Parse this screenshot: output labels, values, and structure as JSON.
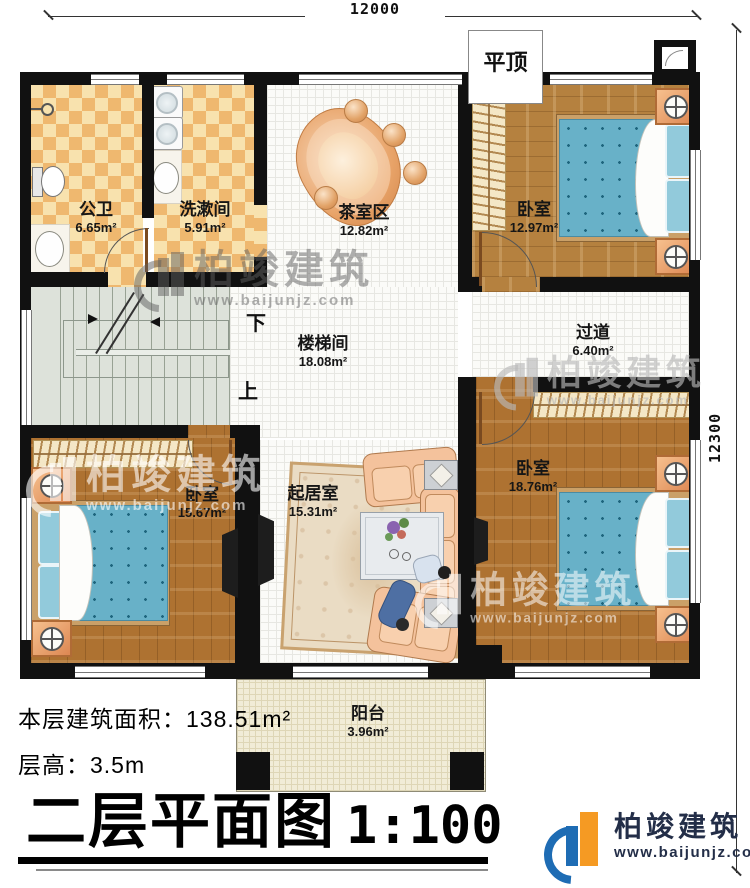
{
  "dimensions": {
    "width": "12000",
    "height": "12300"
  },
  "annotations": {
    "roof": "平顶",
    "stairs_down": "下",
    "stairs_up": "上"
  },
  "rooms": [
    {
      "name": "公卫",
      "area": "6.65m²"
    },
    {
      "name": "洗漱间",
      "area": "5.91m²"
    },
    {
      "name": "茶室区",
      "area": "12.82m²"
    },
    {
      "name": "卧室",
      "area": "12.97m²"
    },
    {
      "name": "过道",
      "area": "6.40m²"
    },
    {
      "name": "楼梯间",
      "area": "18.08m²"
    },
    {
      "name": "卧室",
      "area": "15.67m²"
    },
    {
      "name": "起居室",
      "area": "15.31m²"
    },
    {
      "name": "卧室",
      "area": "18.76m²"
    },
    {
      "name": "阳台",
      "area": "3.96m²"
    }
  ],
  "info": {
    "floor_area_label": "本层建筑面积：",
    "floor_area_value": "138.51m²",
    "story_height_label": "层高：",
    "story_height_value": "3.5m"
  },
  "title": {
    "name": "二层平面图",
    "scale": "1:100"
  },
  "watermark": {
    "brand": "柏竣建筑",
    "url": "www.baijunjz.com"
  },
  "logo": {
    "brand": "柏竣建筑",
    "url": "www.baijunjz.com"
  },
  "colors": {
    "wall": "#111111",
    "wood": "#b5813f",
    "bed_blue": "#68b1c8",
    "checker": "#efb86f",
    "logo_blue": "#1e6cb4",
    "logo_orange": "#f59a23"
  }
}
